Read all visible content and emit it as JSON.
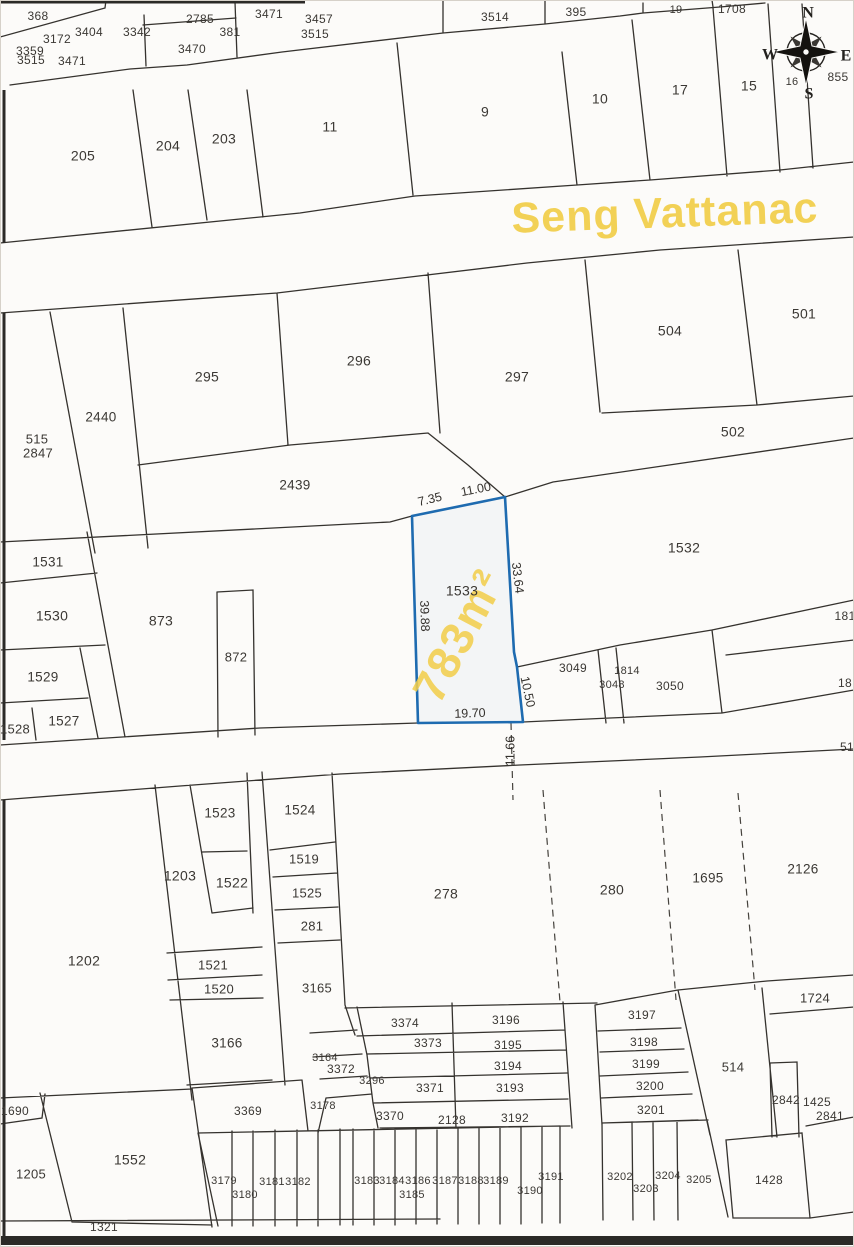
{
  "road": {
    "name": "Seng Vattanac"
  },
  "highlight_parcel": {
    "id": "1533",
    "area": "783m²",
    "outline_color": "#1e6bb0",
    "annotation_color": "#f2cf4e",
    "dimensions": [
      {
        "text": "7.35",
        "x": 430,
        "y": 500,
        "r": -14
      },
      {
        "text": "11.00",
        "x": 476,
        "y": 490,
        "r": -11
      },
      {
        "text": "39.88",
        "x": 424,
        "y": 616,
        "r": 88
      },
      {
        "text": "33.64",
        "x": 517,
        "y": 578,
        "r": 83
      },
      {
        "text": "10.50",
        "x": 527,
        "y": 692,
        "r": 78
      },
      {
        "text": "19.70",
        "x": 470,
        "y": 714,
        "r": -2
      },
      {
        "text": "11.66",
        "x": 511,
        "y": 751,
        "r": -90
      }
    ]
  },
  "compass": {
    "n": "N",
    "e": "E",
    "s": "S",
    "w": "W"
  },
  "colors": {
    "line": "#35322e",
    "text": "#3b3834",
    "road_fill": "#2b2a27",
    "accent_yellow": "#f2cf4e"
  },
  "parcels": [
    {
      "id": "368",
      "x": 38,
      "y": 17,
      "s": 12
    },
    {
      "id": "3359",
      "x": 30,
      "y": 52,
      "s": 12
    },
    {
      "id": "3172",
      "x": 57,
      "y": 40,
      "s": 12
    },
    {
      "id": "3404",
      "x": 89,
      "y": 33,
      "s": 12
    },
    {
      "id": "3342",
      "x": 137,
      "y": 33,
      "s": 12
    },
    {
      "id": "2785",
      "x": 200,
      "y": 20,
      "s": 12
    },
    {
      "id": "381",
      "x": 230,
      "y": 33,
      "s": 12
    },
    {
      "id": "3471",
      "x": 269,
      "y": 15,
      "s": 12
    },
    {
      "id": "3470",
      "x": 192,
      "y": 50,
      "s": 12
    },
    {
      "id": "3515",
      "x": 31,
      "y": 61,
      "s": 12
    },
    {
      "id": "3471",
      "x": 72,
      "y": 62,
      "s": 12
    },
    {
      "id": "3457",
      "x": 319,
      "y": 20,
      "s": 12
    },
    {
      "id": "3515",
      "x": 315,
      "y": 35,
      "s": 12
    },
    {
      "id": "3514",
      "x": 495,
      "y": 18,
      "s": 12
    },
    {
      "id": "395",
      "x": 576,
      "y": 13,
      "s": 12
    },
    {
      "id": "19",
      "x": 676,
      "y": 10,
      "s": 11
    },
    {
      "id": "1708",
      "x": 732,
      "y": 10,
      "s": 12
    },
    {
      "id": "205",
      "x": 83,
      "y": 157,
      "s": 14
    },
    {
      "id": "204",
      "x": 168,
      "y": 147,
      "s": 14
    },
    {
      "id": "203",
      "x": 224,
      "y": 140,
      "s": 14
    },
    {
      "id": "11",
      "x": 330,
      "y": 128,
      "s": 14
    },
    {
      "id": "9",
      "x": 485,
      "y": 113,
      "s": 14
    },
    {
      "id": "10",
      "x": 600,
      "y": 100,
      "s": 14
    },
    {
      "id": "17",
      "x": 680,
      "y": 91,
      "s": 14
    },
    {
      "id": "15",
      "x": 749,
      "y": 87,
      "s": 14
    },
    {
      "id": "16",
      "x": 792,
      "y": 82,
      "s": 11
    },
    {
      "id": "855",
      "x": 838,
      "y": 78,
      "s": 12
    },
    {
      "id": "515",
      "x": 37,
      "y": 440,
      "s": 13
    },
    {
      "id": "2847",
      "x": 38,
      "y": 454,
      "s": 13
    },
    {
      "id": "2440",
      "x": 101,
      "y": 418,
      "s": 13.5
    },
    {
      "id": "295",
      "x": 207,
      "y": 378,
      "s": 14
    },
    {
      "id": "296",
      "x": 359,
      "y": 362,
      "s": 14
    },
    {
      "id": "297",
      "x": 517,
      "y": 378,
      "s": 14
    },
    {
      "id": "504",
      "x": 670,
      "y": 332,
      "s": 14
    },
    {
      "id": "501",
      "x": 804,
      "y": 315,
      "s": 14
    },
    {
      "id": "502",
      "x": 733,
      "y": 433,
      "s": 14
    },
    {
      "id": "2439",
      "x": 295,
      "y": 486,
      "s": 13.5
    },
    {
      "id": "1531",
      "x": 48,
      "y": 563,
      "s": 13.5
    },
    {
      "id": "1530",
      "x": 52,
      "y": 617,
      "s": 14
    },
    {
      "id": "873",
      "x": 161,
      "y": 622,
      "s": 14
    },
    {
      "id": "872",
      "x": 236,
      "y": 658,
      "s": 13
    },
    {
      "id": "1529",
      "x": 43,
      "y": 678,
      "s": 13.5
    },
    {
      "id": "1527",
      "x": 64,
      "y": 722,
      "s": 13.5
    },
    {
      "id": "1528",
      "x": 15,
      "y": 730,
      "s": 13
    },
    {
      "id": "1533",
      "x": 462,
      "y": 592,
      "s": 14
    },
    {
      "id": "1532",
      "x": 684,
      "y": 549,
      "s": 14
    },
    {
      "id": "3049",
      "x": 573,
      "y": 669,
      "s": 12
    },
    {
      "id": "1814",
      "x": 627,
      "y": 671,
      "s": 11
    },
    {
      "id": "3048",
      "x": 612,
      "y": 685,
      "s": 11
    },
    {
      "id": "3050",
      "x": 670,
      "y": 687,
      "s": 12
    },
    {
      "id": "181",
      "x": 845,
      "y": 617,
      "s": 12
    },
    {
      "id": "18",
      "x": 845,
      "y": 684,
      "s": 12
    },
    {
      "id": "51",
      "x": 847,
      "y": 748,
      "s": 12
    },
    {
      "id": "1523",
      "x": 220,
      "y": 814,
      "s": 13.5
    },
    {
      "id": "1524",
      "x": 300,
      "y": 811,
      "s": 13.5
    },
    {
      "id": "1203",
      "x": 180,
      "y": 877,
      "s": 14
    },
    {
      "id": "1522",
      "x": 232,
      "y": 884,
      "s": 14
    },
    {
      "id": "1519",
      "x": 304,
      "y": 860,
      "s": 13
    },
    {
      "id": "1525",
      "x": 307,
      "y": 894,
      "s": 13
    },
    {
      "id": "281",
      "x": 312,
      "y": 927,
      "s": 13
    },
    {
      "id": "278",
      "x": 446,
      "y": 895,
      "s": 14
    },
    {
      "id": "280",
      "x": 612,
      "y": 891,
      "s": 14
    },
    {
      "id": "1695",
      "x": 708,
      "y": 879,
      "s": 13.5
    },
    {
      "id": "2126",
      "x": 803,
      "y": 870,
      "s": 13.5
    },
    {
      "id": "1202",
      "x": 84,
      "y": 962,
      "s": 14
    },
    {
      "id": "1521",
      "x": 213,
      "y": 966,
      "s": 13
    },
    {
      "id": "1520",
      "x": 219,
      "y": 990,
      "s": 13
    },
    {
      "id": "3165",
      "x": 317,
      "y": 989,
      "s": 13
    },
    {
      "id": "3166",
      "x": 227,
      "y": 1044,
      "s": 13.5
    },
    {
      "id": "1724",
      "x": 815,
      "y": 999,
      "s": 13
    },
    {
      "id": "3374",
      "x": 405,
      "y": 1024,
      "s": 12
    },
    {
      "id": "3196",
      "x": 506,
      "y": 1021,
      "s": 12
    },
    {
      "id": "3373",
      "x": 428,
      "y": 1044,
      "s": 12
    },
    {
      "id": "3195",
      "x": 508,
      "y": 1046,
      "s": 12
    },
    {
      "id": "3164",
      "x": 325,
      "y": 1058,
      "s": 11
    },
    {
      "id": "3372",
      "x": 341,
      "y": 1070,
      "s": 12
    },
    {
      "id": "3194",
      "x": 508,
      "y": 1067,
      "s": 12
    },
    {
      "id": "3296",
      "x": 372,
      "y": 1081,
      "s": 11
    },
    {
      "id": "3371",
      "x": 430,
      "y": 1089,
      "s": 12
    },
    {
      "id": "3193",
      "x": 510,
      "y": 1089,
      "s": 12
    },
    {
      "id": "3178",
      "x": 323,
      "y": 1106,
      "s": 11
    },
    {
      "id": "3370",
      "x": 390,
      "y": 1117,
      "s": 12
    },
    {
      "id": "2128",
      "x": 452,
      "y": 1121,
      "s": 12
    },
    {
      "id": "3192",
      "x": 515,
      "y": 1119,
      "s": 12
    },
    {
      "id": "3197",
      "x": 642,
      "y": 1016,
      "s": 12
    },
    {
      "id": "3198",
      "x": 644,
      "y": 1043,
      "s": 12
    },
    {
      "id": "3199",
      "x": 646,
      "y": 1065,
      "s": 12
    },
    {
      "id": "3200",
      "x": 650,
      "y": 1087,
      "s": 12
    },
    {
      "id": "3201",
      "x": 651,
      "y": 1111,
      "s": 12
    },
    {
      "id": "514",
      "x": 733,
      "y": 1068,
      "s": 13
    },
    {
      "id": "2842",
      "x": 786,
      "y": 1101,
      "s": 12
    },
    {
      "id": "1425",
      "x": 817,
      "y": 1103,
      "s": 12
    },
    {
      "id": "2841",
      "x": 830,
      "y": 1117,
      "s": 12
    },
    {
      "id": "1690",
      "x": 15,
      "y": 1112,
      "s": 12
    },
    {
      "id": "3369",
      "x": 248,
      "y": 1112,
      "s": 12
    },
    {
      "id": "1205",
      "x": 31,
      "y": 1175,
      "s": 13
    },
    {
      "id": "1552",
      "x": 130,
      "y": 1161,
      "s": 14
    },
    {
      "id": "1321",
      "x": 104,
      "y": 1228,
      "s": 12
    },
    {
      "id": "3179",
      "x": 224,
      "y": 1181,
      "s": 11
    },
    {
      "id": "3180",
      "x": 245,
      "y": 1195,
      "s": 11
    },
    {
      "id": "3181",
      "x": 272,
      "y": 1182,
      "s": 11
    },
    {
      "id": "3182",
      "x": 298,
      "y": 1182,
      "s": 11
    },
    {
      "id": "3183",
      "x": 367,
      "y": 1181,
      "s": 11
    },
    {
      "id": "3184",
      "x": 392,
      "y": 1181,
      "s": 11
    },
    {
      "id": "3185",
      "x": 412,
      "y": 1195,
      "s": 11
    },
    {
      "id": "3186",
      "x": 418,
      "y": 1181,
      "s": 11
    },
    {
      "id": "3187",
      "x": 445,
      "y": 1181,
      "s": 11
    },
    {
      "id": "3188",
      "x": 471,
      "y": 1181,
      "s": 11
    },
    {
      "id": "3189",
      "x": 496,
      "y": 1181,
      "s": 11
    },
    {
      "id": "3190",
      "x": 530,
      "y": 1191,
      "s": 11
    },
    {
      "id": "3191",
      "x": 551,
      "y": 1177,
      "s": 11
    },
    {
      "id": "3202",
      "x": 620,
      "y": 1177,
      "s": 11
    },
    {
      "id": "3203",
      "x": 646,
      "y": 1189,
      "s": 11
    },
    {
      "id": "3204",
      "x": 668,
      "y": 1176,
      "s": 11
    },
    {
      "id": "3205",
      "x": 699,
      "y": 1180,
      "s": 11
    },
    {
      "id": "1428",
      "x": 769,
      "y": 1181,
      "s": 12
    }
  ]
}
